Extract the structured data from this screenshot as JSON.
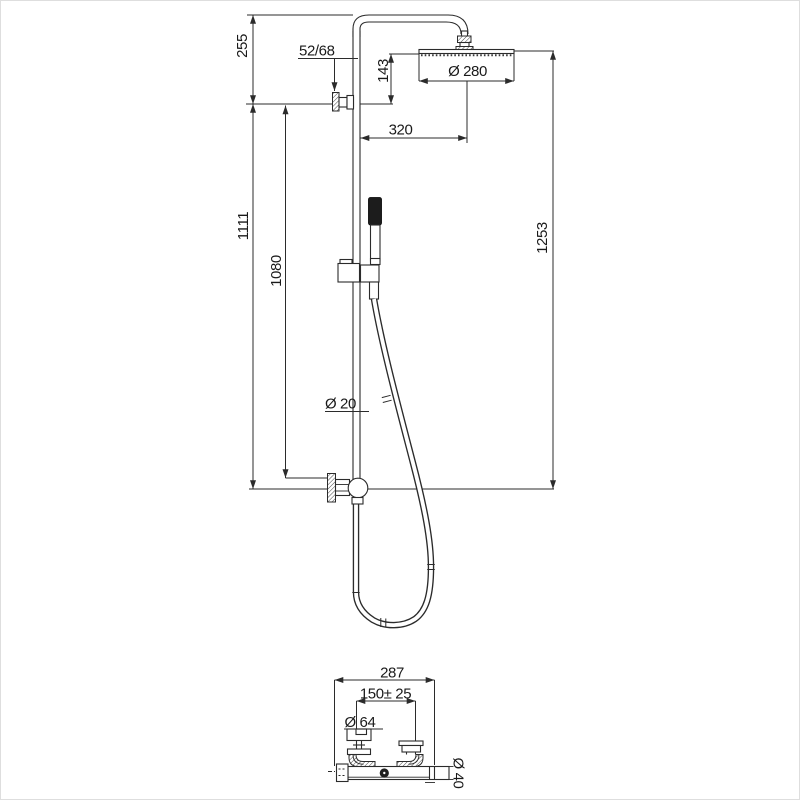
{
  "drawing": {
    "background": "#ffffff",
    "line_color": "#2b2b2b",
    "text_color": "#1a1a1a",
    "front_view": {
      "labels": {
        "top_offset": "255",
        "wall_bracket_depth": "52/68",
        "head_to_bracket": "143",
        "head_diameter": "Ø 280",
        "arm_projection": "320",
        "column_height": "1111",
        "slide_height": "1080",
        "overall_height": "1253",
        "pipe_diameter": "Ø 20"
      }
    },
    "valve_view": {
      "labels": {
        "overall_width": "287",
        "connection_spacing": "150± 25",
        "escutcheon_diameter": "Ø 64",
        "body_diameter": "Ø 40"
      }
    }
  }
}
